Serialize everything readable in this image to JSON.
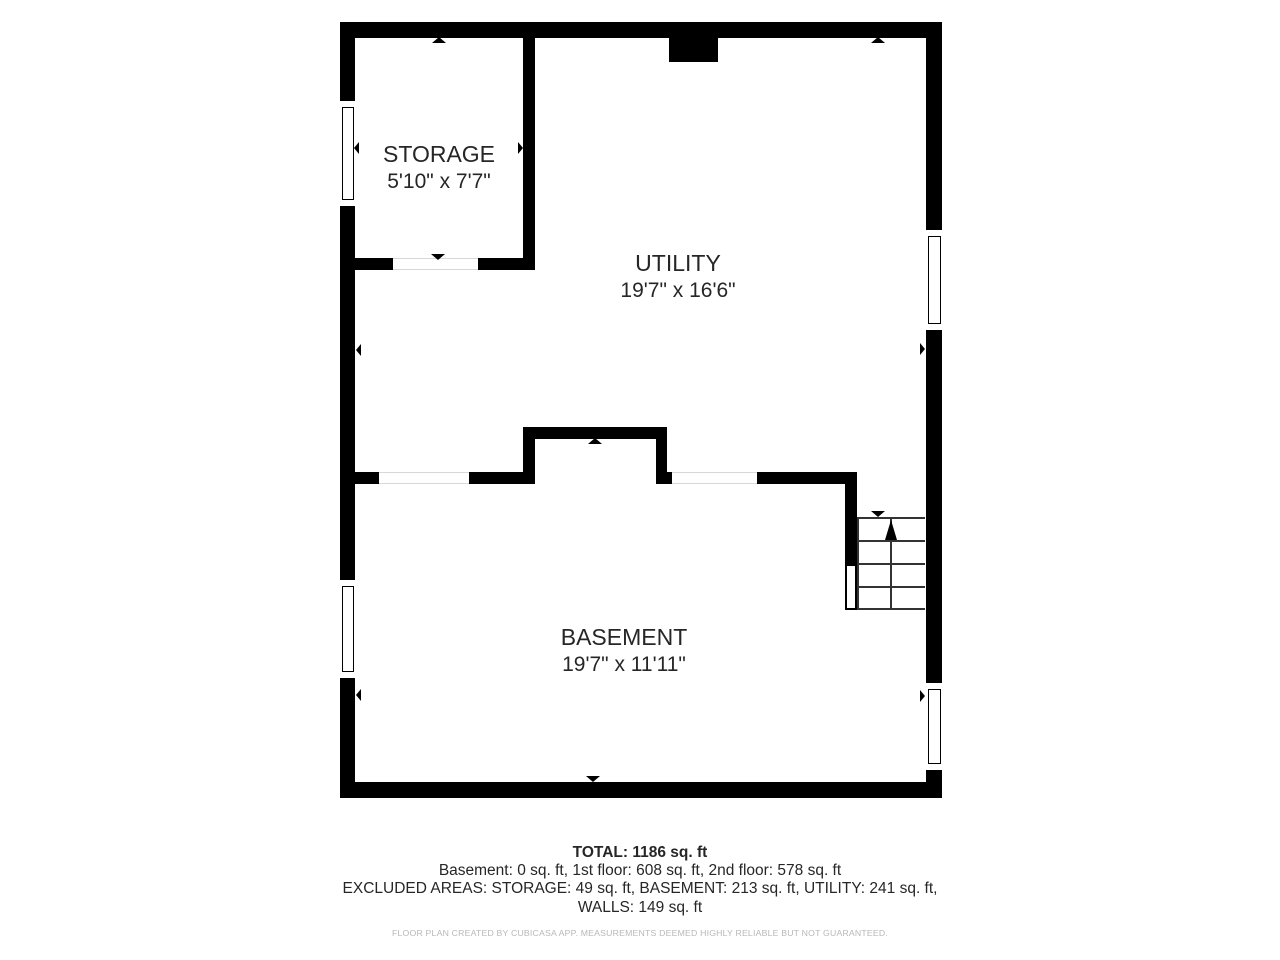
{
  "plan": {
    "rooms": [
      {
        "name": "STORAGE",
        "dimensions": "5'10\" x 7'7\""
      },
      {
        "name": "UTILITY",
        "dimensions": "19'7\" x 16'6\""
      },
      {
        "name": "BASEMENT",
        "dimensions": "19'7\" x 11'11\""
      }
    ],
    "stairs_direction": "up"
  },
  "summary": {
    "total": "TOTAL: 1186 sq. ft",
    "floors": "Basement: 0 sq. ft, 1st floor: 608 sq. ft, 2nd floor: 578 sq. ft",
    "excluded_line1": "EXCLUDED AREAS: STORAGE: 49 sq. ft, BASEMENT: 213 sq. ft, UTILITY: 241 sq. ft,",
    "excluded_line2": "WALLS: 149 sq. ft"
  },
  "footer": {
    "disclaimer": "FLOOR PLAN CREATED BY CUBICASA APP. MEASUREMENTS DEEMED HIGHLY RELIABLE BUT NOT GUARANTEED."
  },
  "colors": {
    "wall": "#000000",
    "text": "#262626",
    "disclaimer": "#b8b8b8",
    "stair_line": "#333333"
  }
}
